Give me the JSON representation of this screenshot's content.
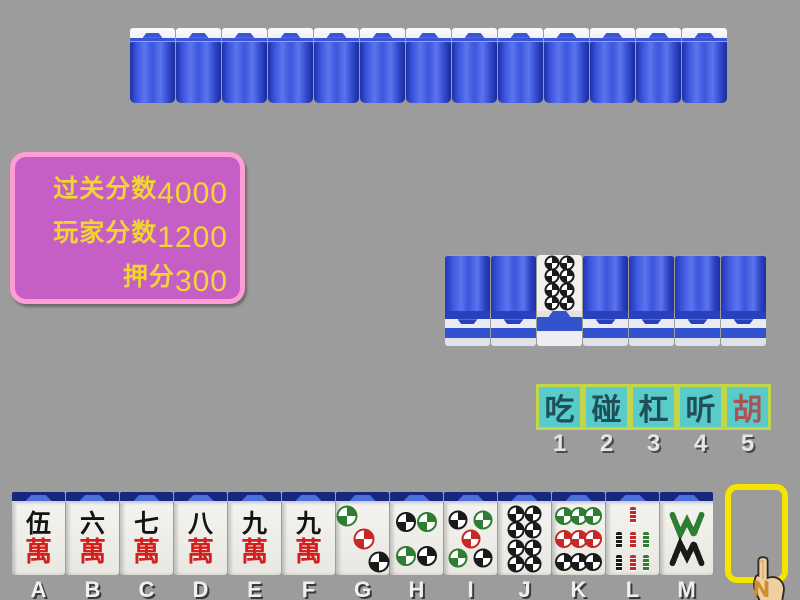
{
  "background_color": "#9c9c9c",
  "score_panel": {
    "fill": "#c55fc5",
    "border_color": "#ff9dd7",
    "text_color": "#f0d335",
    "rows": [
      {
        "label": "过关分数",
        "value": "4000"
      },
      {
        "label": "玩家分数",
        "value": "1200"
      },
      {
        "label": "押分",
        "value": "300"
      }
    ]
  },
  "opponent_row": {
    "tile_count": 13,
    "tile_back_color": "#3c55dc"
  },
  "meld_row": {
    "tiles": [
      {
        "face": "down"
      },
      {
        "face": "down"
      },
      {
        "face": "up",
        "suit": "circle",
        "value": 8
      },
      {
        "face": "down"
      },
      {
        "face": "down"
      },
      {
        "face": "down"
      },
      {
        "face": "down"
      }
    ]
  },
  "action_bar": {
    "fill": "#58cbca",
    "border_color": "#c3d549",
    "buttons": [
      {
        "label": "吃",
        "hotkey": "1",
        "style": "normal"
      },
      {
        "label": "碰",
        "hotkey": "2",
        "style": "normal"
      },
      {
        "label": "杠",
        "hotkey": "3",
        "style": "normal"
      },
      {
        "label": "听",
        "hotkey": "4",
        "style": "normal"
      },
      {
        "label": "胡",
        "hotkey": "5",
        "style": "red"
      }
    ]
  },
  "hand": {
    "wan_char": "萬",
    "tiles": [
      {
        "letter": "A",
        "suit": "wan",
        "char": "伍",
        "value": 5
      },
      {
        "letter": "B",
        "suit": "wan",
        "char": "六",
        "value": 6
      },
      {
        "letter": "C",
        "suit": "wan",
        "char": "七",
        "value": 7
      },
      {
        "letter": "D",
        "suit": "wan",
        "char": "八",
        "value": 8
      },
      {
        "letter": "E",
        "suit": "wan",
        "char": "九",
        "value": 9
      },
      {
        "letter": "F",
        "suit": "wan",
        "char": "九",
        "value": 9
      },
      {
        "letter": "G",
        "suit": "circle",
        "value": 3
      },
      {
        "letter": "H",
        "suit": "circle",
        "value": 4
      },
      {
        "letter": "I",
        "suit": "circle",
        "value": 5
      },
      {
        "letter": "J",
        "suit": "circle",
        "value": 8
      },
      {
        "letter": "K",
        "suit": "circle",
        "value": 9
      },
      {
        "letter": "L",
        "suit": "bamboo",
        "value": 7
      },
      {
        "letter": "M",
        "suit": "bamboo",
        "value": 8
      }
    ]
  },
  "draw_slot": {
    "label": "N",
    "border_color": "#f4e400"
  },
  "suit_colors": {
    "green": "#2e7d32",
    "red": "#c62828",
    "black": "#1a1a1a"
  }
}
